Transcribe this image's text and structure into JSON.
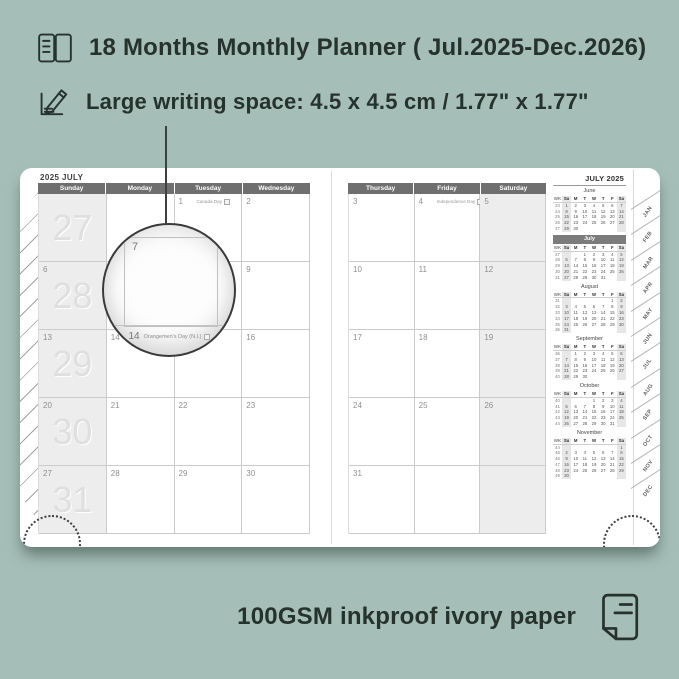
{
  "colors": {
    "background": "#a5bfb8",
    "annotation_text": "#26322c",
    "page_white": "#ffffff",
    "weekday_header_bar": "#6f6f6f",
    "weekend_shade": "#ededed",
    "grid_line": "#cbcbcb",
    "watermark_number": "#dfdfdf",
    "date_number": "#8f8f8f",
    "mini_current_month_bar": "#7b7b7b"
  },
  "features": {
    "months": {
      "icon": "planner-book-icon",
      "label": "18 Months Monthly Planner ( Jul.2025-Dec.2026)"
    },
    "writing_space": {
      "icon": "writing-pencil-icon",
      "label": "Large writing space: 4.5 x 4.5 cm / 1.77\" x 1.77\""
    },
    "paper": {
      "icon": "paper-sheet-icon",
      "label": "100GSM inkproof ivory paper"
    }
  },
  "planner": {
    "left_page": {
      "title": "2025 JULY",
      "day_headers": [
        "Sunday",
        "Monday",
        "Tuesday",
        "Wednesday"
      ],
      "weeks": [
        {
          "watermark": "27",
          "days": [
            {
              "date": ""
            },
            {
              "date": ""
            },
            {
              "date": "1",
              "holiday": "Canada Day"
            },
            {
              "date": "2"
            }
          ]
        },
        {
          "watermark": "28",
          "days": [
            {
              "date": "6"
            },
            {
              "date": "7"
            },
            {
              "date": "8"
            },
            {
              "date": "9"
            }
          ]
        },
        {
          "watermark": "29",
          "days": [
            {
              "date": "13"
            },
            {
              "date": "14",
              "holiday": "Orangemen's Day (N.I.)"
            },
            {
              "date": "15"
            },
            {
              "date": "16"
            }
          ]
        },
        {
          "watermark": "30",
          "days": [
            {
              "date": "20"
            },
            {
              "date": "21"
            },
            {
              "date": "22"
            },
            {
              "date": "23"
            }
          ]
        },
        {
          "watermark": "31",
          "days": [
            {
              "date": "27"
            },
            {
              "date": "28"
            },
            {
              "date": "29"
            },
            {
              "date": "30"
            }
          ]
        }
      ]
    },
    "right_page": {
      "day_headers": [
        "Thursday",
        "Friday",
        "Saturday"
      ],
      "weeks": [
        {
          "days": [
            {
              "date": "3"
            },
            {
              "date": "4",
              "holiday": "Independence Day"
            },
            {
              "date": "5"
            }
          ]
        },
        {
          "days": [
            {
              "date": "10"
            },
            {
              "date": "11"
            },
            {
              "date": "12"
            }
          ]
        },
        {
          "days": [
            {
              "date": "17"
            },
            {
              "date": "18"
            },
            {
              "date": "19"
            }
          ]
        },
        {
          "days": [
            {
              "date": "24"
            },
            {
              "date": "25"
            },
            {
              "date": "26"
            }
          ]
        },
        {
          "days": [
            {
              "date": "31"
            },
            {
              "date": ""
            },
            {
              "date": ""
            }
          ]
        }
      ]
    },
    "magnifier": {
      "date": "7",
      "footer_date": "14",
      "footer_holiday": "Orangemen's Day (N.I.)"
    },
    "sidebar": {
      "title": "JULY 2025",
      "week_header": [
        "WK",
        "Su",
        "M",
        "T",
        "W",
        "T",
        "F",
        "Sa"
      ],
      "months": [
        {
          "name": "June",
          "current": false,
          "rows": [
            [
              "23",
              "1",
              "2",
              "3",
              "4",
              "5",
              "6",
              "7"
            ],
            [
              "24",
              "8",
              "9",
              "10",
              "11",
              "12",
              "13",
              "14"
            ],
            [
              "25",
              "15",
              "16",
              "17",
              "18",
              "19",
              "20",
              "21"
            ],
            [
              "26",
              "22",
              "23",
              "24",
              "25",
              "26",
              "27",
              "28"
            ],
            [
              "27",
              "29",
              "30",
              "",
              "",
              "",
              "",
              ""
            ]
          ]
        },
        {
          "name": "July",
          "current": true,
          "rows": [
            [
              "27",
              "",
              "",
              "1",
              "2",
              "3",
              "4",
              "5"
            ],
            [
              "28",
              "6",
              "7",
              "8",
              "9",
              "10",
              "11",
              "12"
            ],
            [
              "29",
              "13",
              "14",
              "15",
              "16",
              "17",
              "18",
              "19"
            ],
            [
              "30",
              "20",
              "21",
              "22",
              "23",
              "24",
              "25",
              "26"
            ],
            [
              "31",
              "27",
              "28",
              "29",
              "30",
              "31",
              "",
              ""
            ]
          ]
        },
        {
          "name": "August",
          "current": false,
          "rows": [
            [
              "31",
              "",
              "",
              "",
              "",
              "",
              "1",
              "2"
            ],
            [
              "32",
              "3",
              "4",
              "5",
              "6",
              "7",
              "8",
              "9"
            ],
            [
              "33",
              "10",
              "11",
              "12",
              "13",
              "14",
              "15",
              "16"
            ],
            [
              "34",
              "17",
              "18",
              "19",
              "20",
              "21",
              "22",
              "23"
            ],
            [
              "35",
              "24",
              "25",
              "26",
              "27",
              "28",
              "29",
              "30"
            ],
            [
              "36",
              "31",
              "",
              "",
              "",
              "",
              "",
              ""
            ]
          ]
        },
        {
          "name": "September",
          "current": false,
          "rows": [
            [
              "36",
              "",
              "1",
              "2",
              "3",
              "4",
              "5",
              "6"
            ],
            [
              "37",
              "7",
              "8",
              "9",
              "10",
              "11",
              "12",
              "13"
            ],
            [
              "38",
              "14",
              "15",
              "16",
              "17",
              "18",
              "19",
              "20"
            ],
            [
              "39",
              "21",
              "22",
              "23",
              "24",
              "25",
              "26",
              "27"
            ],
            [
              "40",
              "28",
              "29",
              "30",
              "",
              "",
              "",
              ""
            ]
          ]
        },
        {
          "name": "October",
          "current": false,
          "rows": [
            [
              "40",
              "",
              "",
              "",
              "1",
              "2",
              "3",
              "4"
            ],
            [
              "41",
              "5",
              "6",
              "7",
              "8",
              "9",
              "10",
              "11"
            ],
            [
              "42",
              "12",
              "13",
              "14",
              "15",
              "16",
              "17",
              "18"
            ],
            [
              "43",
              "19",
              "20",
              "21",
              "22",
              "23",
              "24",
              "25"
            ],
            [
              "44",
              "26",
              "27",
              "28",
              "29",
              "30",
              "31",
              ""
            ]
          ]
        },
        {
          "name": "November",
          "current": false,
          "rows": [
            [
              "44",
              "",
              "",
              "",
              "",
              "",
              "",
              "1"
            ],
            [
              "45",
              "2",
              "3",
              "4",
              "5",
              "6",
              "7",
              "8"
            ],
            [
              "46",
              "9",
              "10",
              "11",
              "12",
              "13",
              "14",
              "15"
            ],
            [
              "47",
              "16",
              "17",
              "18",
              "19",
              "20",
              "21",
              "22"
            ],
            [
              "48",
              "23",
              "24",
              "25",
              "26",
              "27",
              "28",
              "29"
            ],
            [
              "49",
              "30",
              "",
              "",
              "",
              "",
              "",
              ""
            ]
          ]
        }
      ]
    },
    "tabs": [
      "JAN",
      "FEB",
      "MAR",
      "APR",
      "MAY",
      "JUN",
      "JUL",
      "AUG",
      "SEP",
      "OCT",
      "NOV",
      "DEC"
    ]
  }
}
